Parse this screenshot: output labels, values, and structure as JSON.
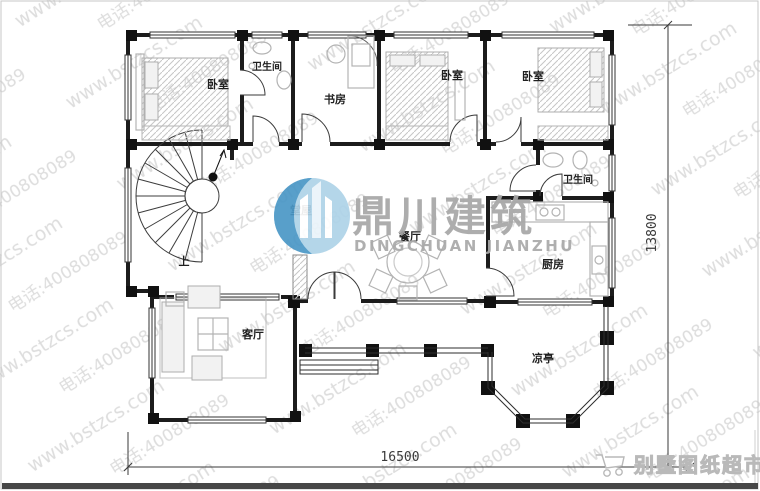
{
  "watermark": {
    "line1": "www.bstzcs.com",
    "line2": "电话:400808089"
  },
  "logo": {
    "cn": "鼎川建筑",
    "en": "DINGCHUAN JIANZHU"
  },
  "brand": {
    "label": "别墅图纸超市"
  },
  "dimensions": {
    "width_mm": "16500",
    "height_mm": "13800"
  },
  "rooms": {
    "bedroom": "卧室",
    "bathroom": "卫生间",
    "study": "书房",
    "hall": "堂屋",
    "dining": "餐厅",
    "kitchen": "厨房",
    "living": "客厅",
    "pavilion": "凉亭",
    "stair_up": "上"
  }
}
